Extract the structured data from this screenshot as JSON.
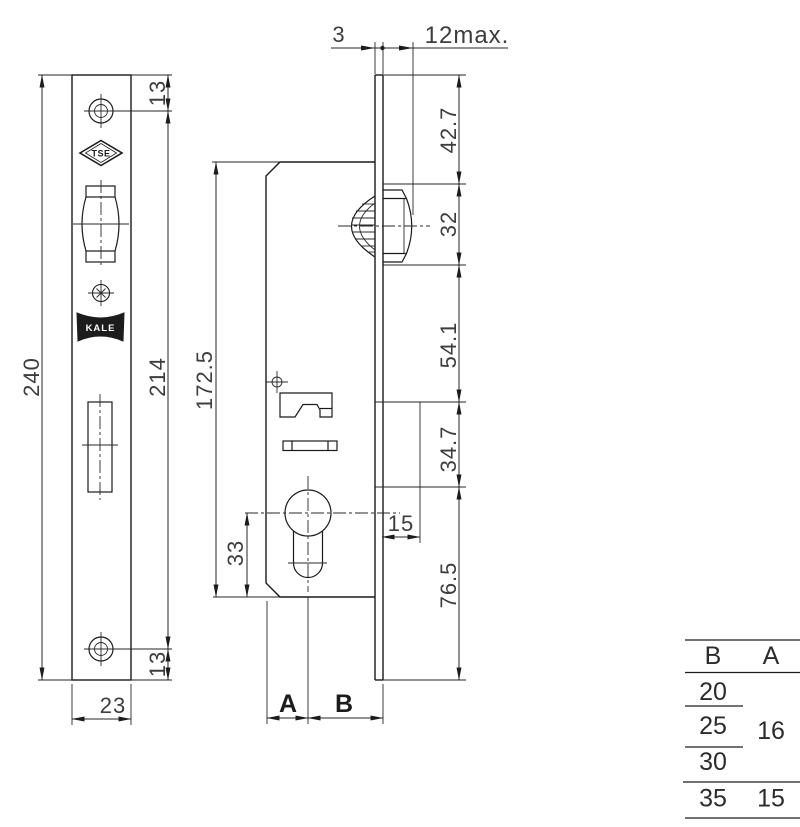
{
  "colors": {
    "background": "#ffffff",
    "outline": "#1a1a1a",
    "dim_line": "#262626",
    "text": "#3d3d3d",
    "logo_fill": "#1c1c1c"
  },
  "front_view": {
    "overall_height": "240",
    "screw_spacing": "214",
    "screw_offset_top": "13",
    "screw_offset_bottom": "13",
    "plate_width": "23",
    "tse_logo_text": "TSE",
    "kale_logo_text": "KALE"
  },
  "section_view": {
    "case_height": "172.5",
    "cylinder_to_bottom": "33",
    "plate_thickness": "3",
    "max_projection": "12max.",
    "cutout_depth": "15",
    "backset_a": "A",
    "backset_b": "B"
  },
  "profile_chain": {
    "top_section": "42.7",
    "roller_section": "32",
    "mid_section": "54.1",
    "cylinder_section": "34.7",
    "bottom_section": "76.5"
  },
  "size_table": {
    "header_b": "B",
    "header_a": "A",
    "rows": [
      {
        "b": "20",
        "a": ""
      },
      {
        "b": "25",
        "a": "16"
      },
      {
        "b": "30",
        "a": ""
      },
      {
        "b": "35",
        "a": "15"
      }
    ]
  }
}
